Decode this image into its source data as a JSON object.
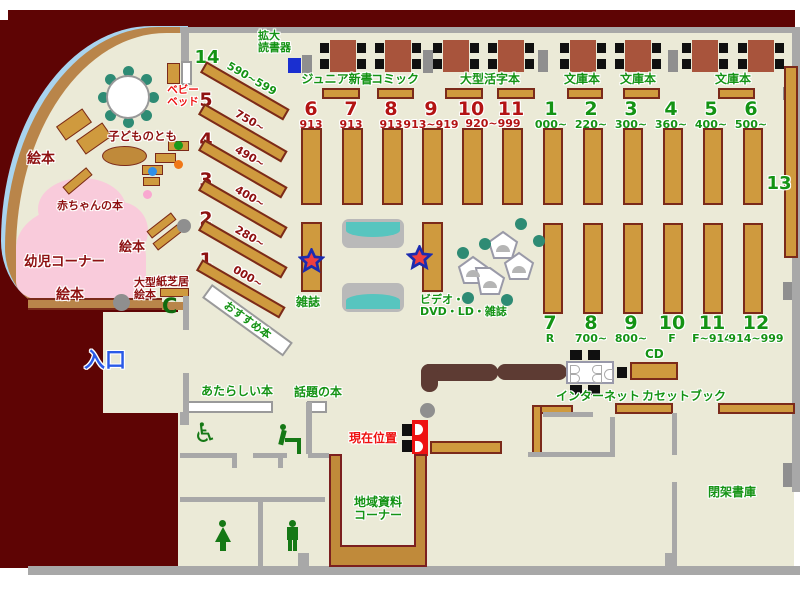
{
  "entrance": {
    "label": "入口"
  },
  "kids": {
    "picture_books": "絵本",
    "kodomo_no_tomo": "子どものとも",
    "baby_books": "赤ちゃんの本",
    "toddler_corner": "幼児コーナー",
    "baby_bed_l1": "ベビー",
    "baby_bed_l2": "ベッド",
    "large_picture_l1": "大型",
    "large_picture_l2": "絵本",
    "kamishibai": "紙芝居",
    "phone_icon_glyph": "C"
  },
  "fan_shelves": {
    "items": [
      {
        "no": "14",
        "range": "590~599"
      },
      {
        "no": "5",
        "range": "750~"
      },
      {
        "no": "4",
        "range": "490~"
      },
      {
        "no": "3",
        "range": "400~"
      },
      {
        "no": "2",
        "range": "280~"
      },
      {
        "no": "1",
        "range": "000~"
      }
    ],
    "recommended": "おすすめ本"
  },
  "top": {
    "reader_l1": "拡大",
    "reader_l2": "読書器",
    "junior": "ジュニア新書",
    "comic": "コミック",
    "large_print": "大型活字本",
    "bunko": "文庫本"
  },
  "stacks": {
    "red": [
      {
        "no": "6",
        "range": "913"
      },
      {
        "no": "7",
        "range": "913"
      },
      {
        "no": "8",
        "range": "913"
      },
      {
        "no": "9",
        "range": "913~919"
      },
      {
        "no": "10",
        "range": ""
      },
      {
        "no": "11",
        "range": ""
      }
    ],
    "red_shared_range": "920~999",
    "green_top": [
      {
        "no": "1",
        "range": "000~"
      },
      {
        "no": "2",
        "range": "220~"
      },
      {
        "no": "3",
        "range": "300~"
      },
      {
        "no": "4",
        "range": "360~"
      },
      {
        "no": "5",
        "range": "400~"
      },
      {
        "no": "6",
        "range": "500~"
      }
    ],
    "green_bottom": [
      {
        "no": "7",
        "range": "R"
      },
      {
        "no": "8",
        "range": "700~"
      },
      {
        "no": "9",
        "range": "800~"
      },
      {
        "no": "10",
        "range": "F"
      },
      {
        "no": "11",
        "range": "F~914"
      },
      {
        "no": "12",
        "range": "914~999"
      }
    ],
    "side_shelf": "13"
  },
  "center": {
    "magazine": "雑誌",
    "video_l1": "ビデオ・",
    "video_l2": "DVD・LD・雑誌"
  },
  "south": {
    "new_books": "あたらしい本",
    "topic_books": "話題の本",
    "current_location": "現在位置",
    "local_l1": "地域資料",
    "local_l2": "コーナー",
    "internet": "インターネット",
    "cd": "CD",
    "cassette": "カセットブック",
    "closed_stacks": "閉架書庫"
  },
  "colors": {
    "outside": "#5e0404",
    "floor": "#ebead7",
    "shelf": "#cf9a3e",
    "green_text": "#149314",
    "dark_red_text": "#8e1111",
    "accent_blue": "#2a5ae8",
    "teal": "#2e8b74",
    "pink_area": "#f9cbdb"
  }
}
